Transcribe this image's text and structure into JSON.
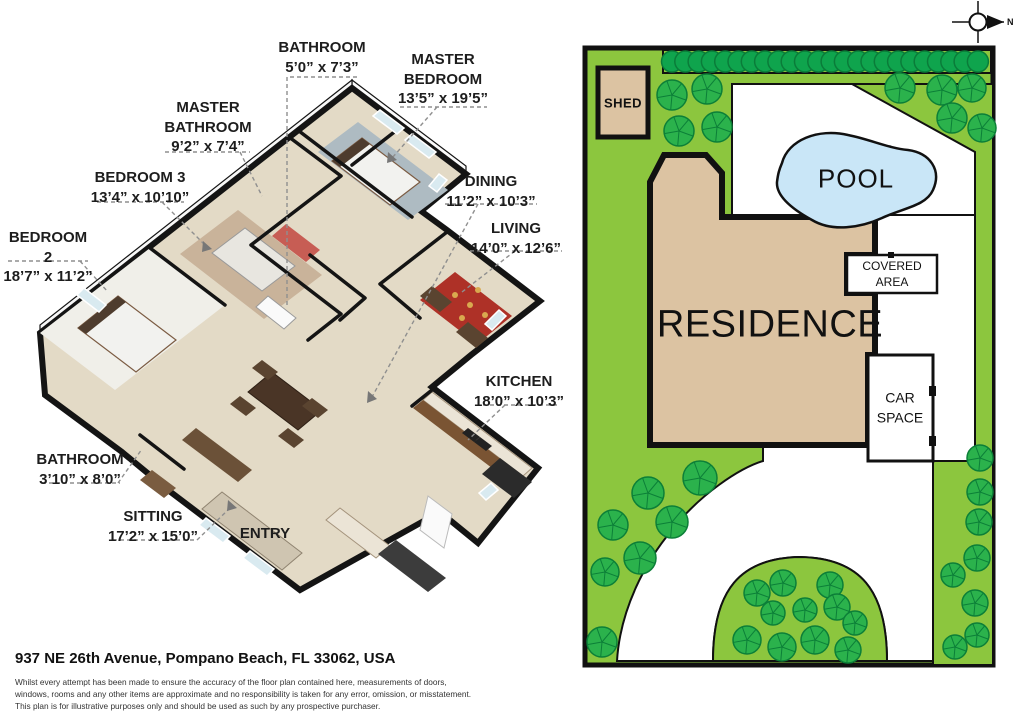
{
  "floor_plan": {
    "labels": [
      {
        "id": "bathroom-top",
        "name": "BATHROOM",
        "dims": "5’0” x 7’3”"
      },
      {
        "id": "master-bedroom",
        "name": "MASTER BEDROOM",
        "dims": "13’5” x 19’5”"
      },
      {
        "id": "master-bathroom",
        "name": "MASTER BATHROOM",
        "dims": "9’2” x 7’4”"
      },
      {
        "id": "bedroom-3",
        "name": "BEDROOM 3",
        "dims": "13’4” x 10’10”"
      },
      {
        "id": "bedroom-2",
        "name": "BEDROOM 2",
        "dims": "18’7” x 11’2”"
      },
      {
        "id": "dining",
        "name": "DINING",
        "dims": "11’2” x 10’3”"
      },
      {
        "id": "living",
        "name": "LIVING",
        "dims": "14’0” x 12’6”"
      },
      {
        "id": "kitchen",
        "name": "KITCHEN",
        "dims": "18’0” x 10’3”"
      },
      {
        "id": "bathroom-lower",
        "name": "BATHROOM",
        "dims": "3’10” x 8’0”"
      },
      {
        "id": "sitting",
        "name": "SITTING",
        "dims": "17’2” x 15’0”"
      },
      {
        "id": "entry",
        "name": "ENTRY",
        "dims": ""
      }
    ]
  },
  "site_plan": {
    "shed_label": "SHED",
    "pool_label": "POOL",
    "residence_label": "RESIDENCE",
    "covered_area_label": "COVERED AREA",
    "car_space_label": "CAR SPACE",
    "compass_label": "N",
    "colors": {
      "grass": "#8CC63E",
      "tree": "#2BB24C",
      "hedge": "#0FA44D",
      "building_tan": "#DCC3A2",
      "pool_blue": "#C9E6F7",
      "outline": "#111111",
      "floor_beige": "#E3DAC6",
      "rug_red": "#AE3127"
    }
  },
  "footer": {
    "address": "937 NE 26th Avenue, Pompano Beach, FL 33062, USA",
    "disclaimer_lines": [
      "Whilst every attempt has been made to ensure the accuracy of the floor plan contained here, measurements of doors,",
      "windows, rooms and any other items are approximate and no responsibility is taken for any error, omission, or misstatement.",
      "This plan is for illustrative purposes only and should be used as such by any prospective purchaser."
    ]
  }
}
